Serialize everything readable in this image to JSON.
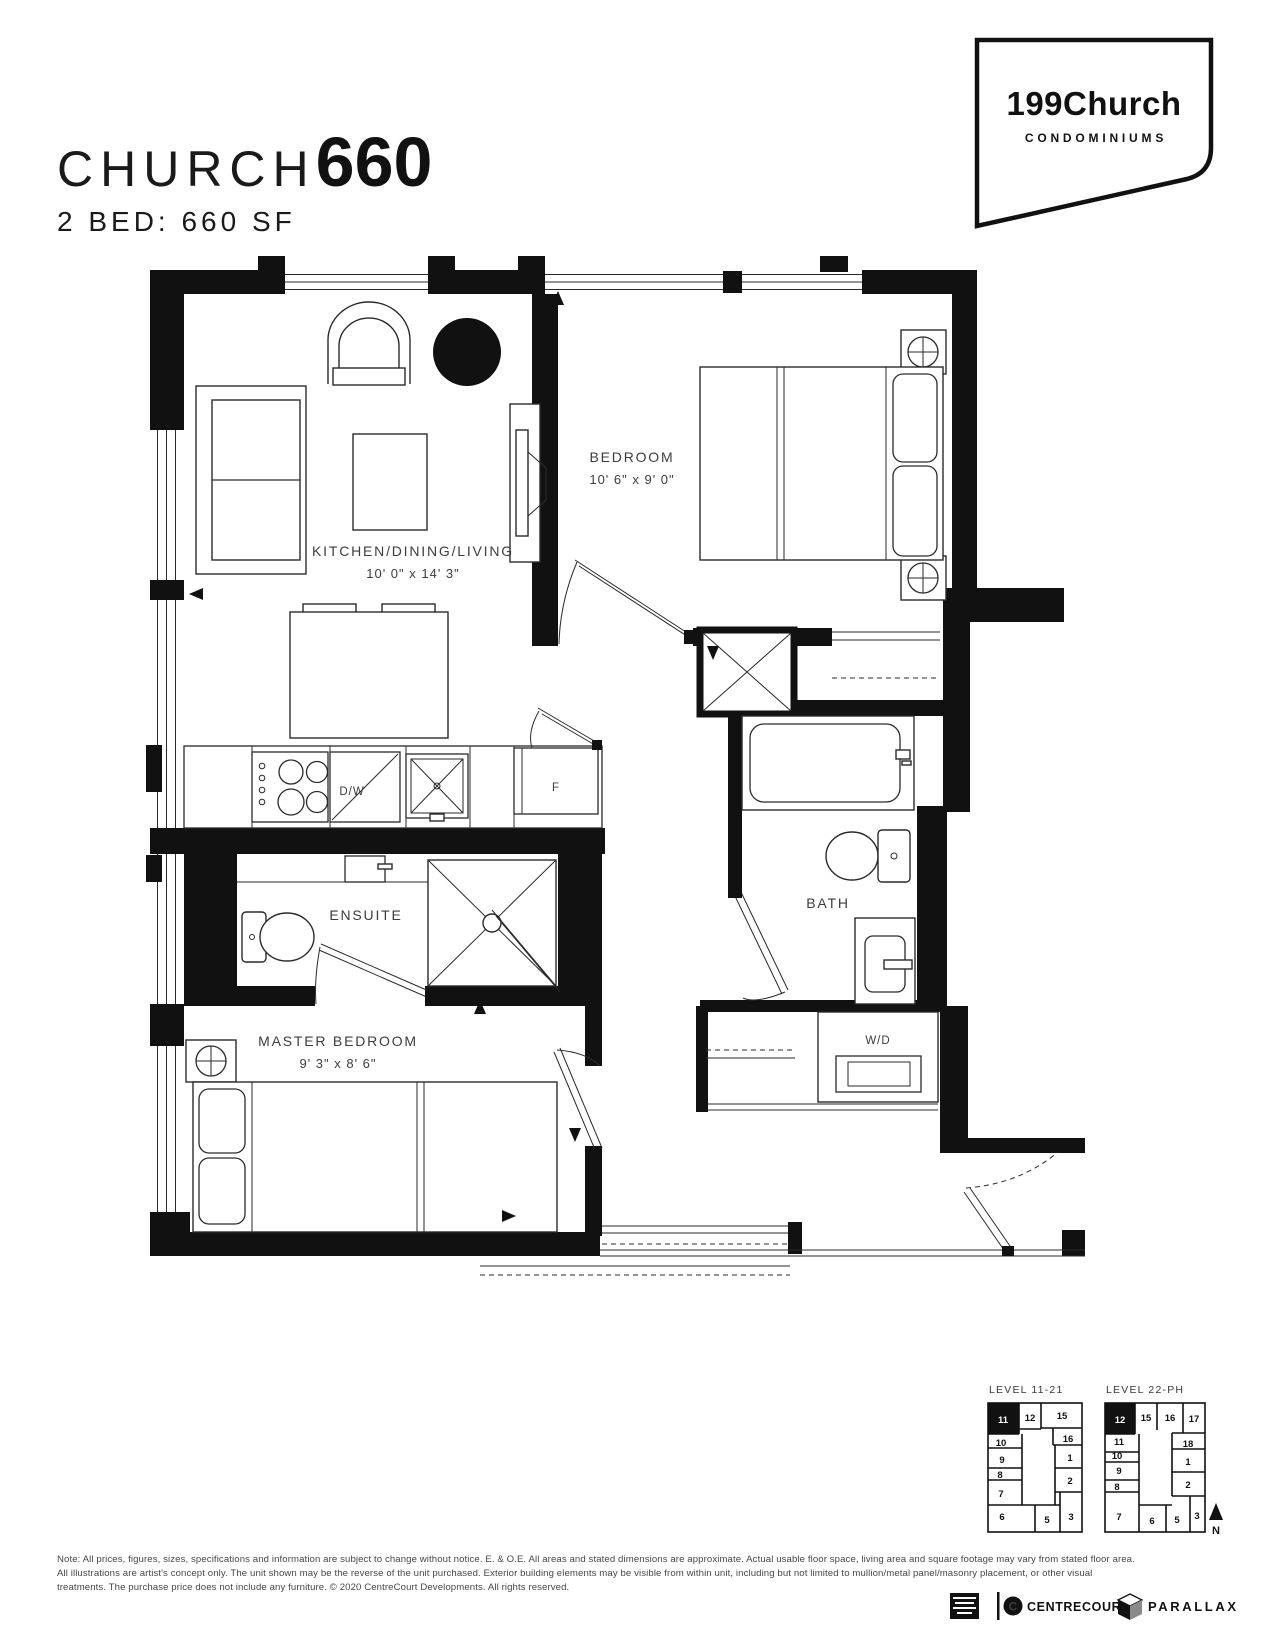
{
  "header": {
    "title_light": "CHURCH",
    "title_bold": "660",
    "subtitle": "2 BED: 660 SF"
  },
  "logo": {
    "name": "199Church",
    "tagline": "CONDOMINIUMS"
  },
  "floorplan": {
    "rooms": {
      "kitchen": {
        "name": "KITCHEN/DINING/LIVING",
        "dims": "10' 0\" x 14' 3\""
      },
      "bedroom": {
        "name": "BEDROOM",
        "dims": "10' 6\" x 9' 0\""
      },
      "ensuite": {
        "name": "ENSUITE"
      },
      "bath": {
        "name": "BATH"
      },
      "master": {
        "name": "MASTER BEDROOM",
        "dims": "9' 3\" x 8' 6\""
      }
    },
    "fixtures": {
      "dishwasher": "D/W",
      "fridge": "F",
      "washer_dryer": "W/D"
    }
  },
  "keyplans": [
    {
      "title": "LEVEL 11-21",
      "highlighted_unit": "11",
      "cells": {
        "u11": "11",
        "u12": "12",
        "u15": "15",
        "u16": "16",
        "u1": "1",
        "u2": "2",
        "u3": "3",
        "u5": "5",
        "u6": "6",
        "u7": "7",
        "u8": "8",
        "u9": "9",
        "u10": "10"
      }
    },
    {
      "title": "LEVEL 22-PH",
      "highlighted_unit": "12",
      "cells": {
        "u12": "12",
        "u15": "15",
        "u16": "16",
        "u17": "17",
        "u18": "18",
        "u1": "1",
        "u2": "2",
        "u3": "3",
        "u5": "5",
        "u6": "6",
        "u7": "7",
        "u8": "8",
        "u9": "9",
        "u10": "10",
        "u11": "11"
      }
    }
  ],
  "compass": {
    "label": "N"
  },
  "footer": {
    "disclaimer": {
      "line1": "Note: All prices, figures, sizes, specifications and information are subject to change without notice. E. & O.E. All areas and stated dimensions are approximate. Actual usable floor space, living area and square footage may vary from stated floor area.",
      "line2": "All illustrations are artist's concept only. The unit shown may be the reverse of the unit purchased. Exterior building elements may be visible from within unit, including but not limited to mullion/metal panel/masonry placement, or other visual",
      "line3": "treatments. The purchase price does not include any furniture. © 2020 CentreCourt Developments. All rights reserved."
    },
    "brands": {
      "centrecourt": "CENTRECOURT",
      "parallax": "PARALLAX"
    }
  }
}
